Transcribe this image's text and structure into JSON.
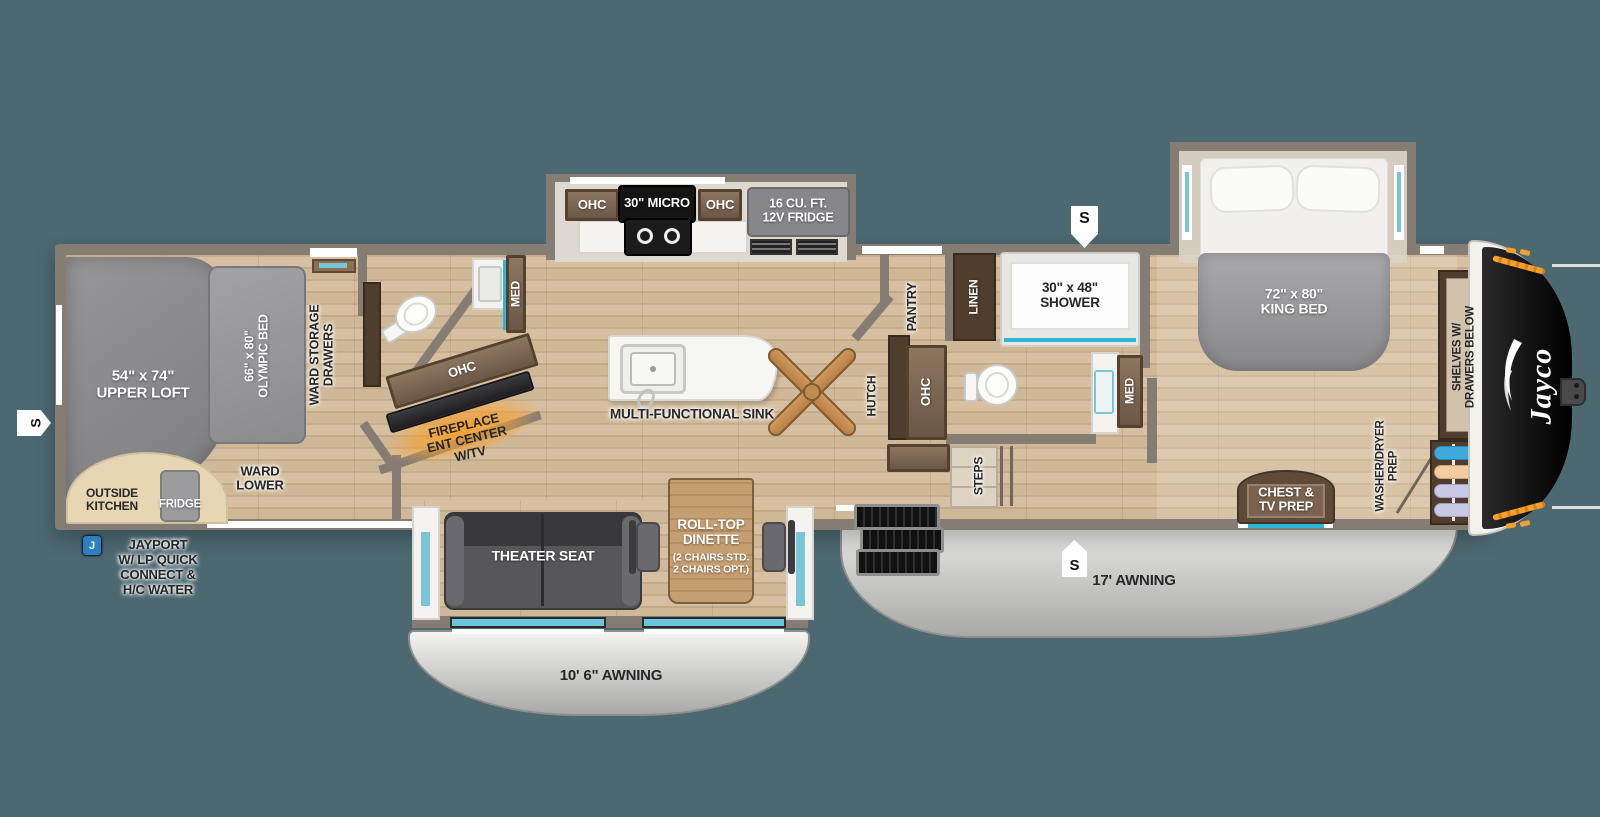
{
  "exterior": {
    "brand": "Jayco",
    "awning_main": "17' AWNING",
    "awning_garage": "10' 6\" AWNING"
  },
  "badges": {
    "slide": "S",
    "jayport": "J"
  },
  "garage": {
    "upper_loft": "54\" x 74\"\nUPPER LOFT",
    "olympic_bed": "66\" x 80\"\nOLYMPIC BED",
    "ward_storage": "WARD STORAGE\nDRAWERS",
    "ward_lower": "WARD\nLOWER",
    "outside_kitchen": "OUTSIDE\nKITCHEN",
    "fridge": "FRIDGE",
    "jayport_note": "JAYPORT\nW/ LP QUICK\nCONNECT &\nH/C WATER"
  },
  "kitchen": {
    "ohc_left": "OHC",
    "micro": "30\" MICRO",
    "ohc_right": "OHC",
    "fridge_12v": "16 CU. FT.\n12V FRIDGE",
    "island_sink": "MULTI-FUNCTIONAL SINK",
    "hutch": "HUTCH",
    "pantry": "PANTRY",
    "ohc_hutch": "OHC"
  },
  "front_bath": {
    "med": "MED",
    "ohc": "OHC",
    "fireplace": "FIREPLACE\nENT CENTER\nW/TV"
  },
  "rear_bath": {
    "linen": "LINEN",
    "shower": "30\" x 48\"\nSHOWER",
    "med": "MED",
    "steps": "STEPS"
  },
  "bedroom": {
    "king_bed": "72\" x 80\"\nKING BED",
    "shelves": "SHELVES W/\nDRAWERS BELOW",
    "chest": "CHEST &\nTV PREP",
    "washer_dryer": "WASHER/DRYER\nPREP"
  },
  "living": {
    "theater_seat": "THEATER SEAT",
    "dinette_title": "ROLL-TOP\nDINETTE",
    "dinette_sub": "(2 CHAIRS STD.\n2 CHAIRS OPT.)"
  },
  "colors": {
    "background": "#4c6871",
    "floor_wood": "#cbb394",
    "wall": "#857d74",
    "cabinet_brown": "#6b5746",
    "dark_wood": "#4f3d2d",
    "awning_silver": "#d7d7d5",
    "glass_teal": "#7bc6d6",
    "shower_accent": "#2fb5d6",
    "fireplace_glow": "#f5a02d",
    "jayport_blue": "#2d7fc1",
    "front_cap_black": "#141414"
  }
}
